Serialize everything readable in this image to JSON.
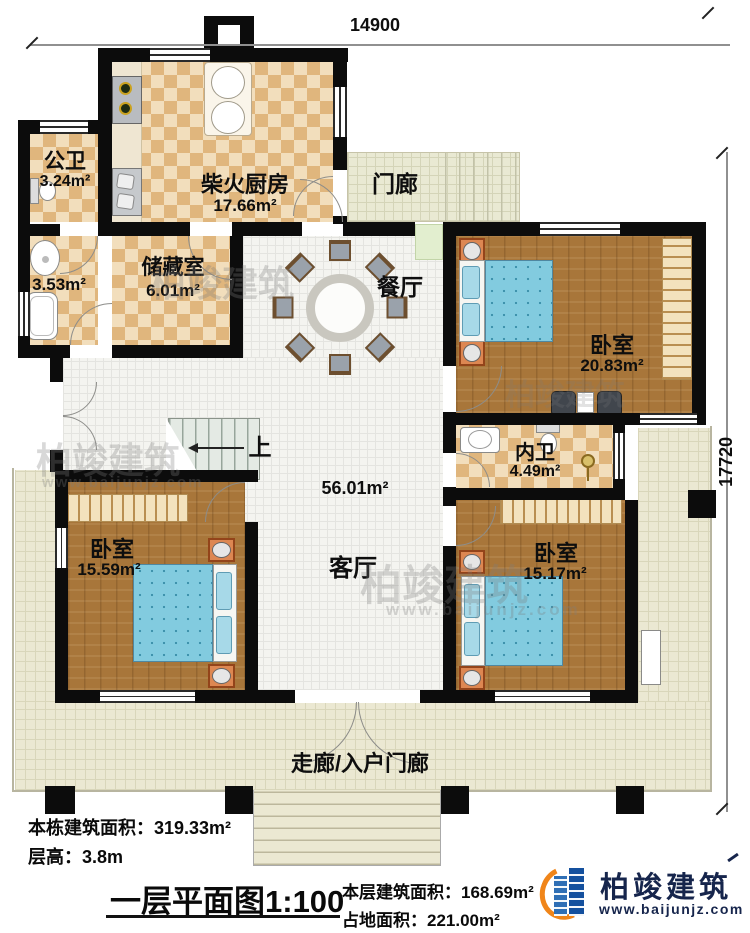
{
  "dimensions": {
    "top": "14900",
    "right": "17720"
  },
  "rooms": {
    "kitchen": {
      "name": "柴火厨房",
      "area": "17.66m²"
    },
    "public_bath": {
      "name": "公卫",
      "area": "3.24m²"
    },
    "small_bath": {
      "area": "3.53m²"
    },
    "storage": {
      "name": "储藏室",
      "area": "6.01m²"
    },
    "porch": {
      "name": "门廊"
    },
    "dining": {
      "name": "餐厅"
    },
    "living": {
      "name": "客厅",
      "area": "56.01m²"
    },
    "bedroom_ne": {
      "name": "卧室",
      "area": "20.83m²"
    },
    "inner_bath": {
      "name": "内卫",
      "area": "4.49m²"
    },
    "bedroom_sw": {
      "name": "卧室",
      "area": "15.59m²"
    },
    "bedroom_se": {
      "name": "卧室",
      "area": "15.17m²"
    },
    "corridor": {
      "name": "走廊/入户门廊"
    }
  },
  "stairs": {
    "up": "上"
  },
  "title_block": {
    "total_area_label": "本栋建筑面积：",
    "total_area_value": "319.33m²",
    "floor_height_label": "层高：",
    "floor_height_value": "3.8m",
    "plan_title": "一层平面图",
    "plan_scale": "1:100",
    "floor_area_label": "本层建筑面积：",
    "floor_area_value": "168.69m²",
    "ground_area_label": "占地面积：",
    "ground_area_value": "221.00m²"
  },
  "brand": {
    "name": "柏竣建筑",
    "website": "www.baijunjz.com",
    "blue": "#1a5cab",
    "orange": "#f08519",
    "text_color": "#16254c"
  },
  "colors": {
    "wall": "#0c0c0c",
    "checker_dark": "#e0b67d",
    "checker_light": "#f2debc",
    "wood_floor": "#a8763a",
    "veranda_tile": "#ebe8d2",
    "bed_fabric": "#82cbdf"
  }
}
